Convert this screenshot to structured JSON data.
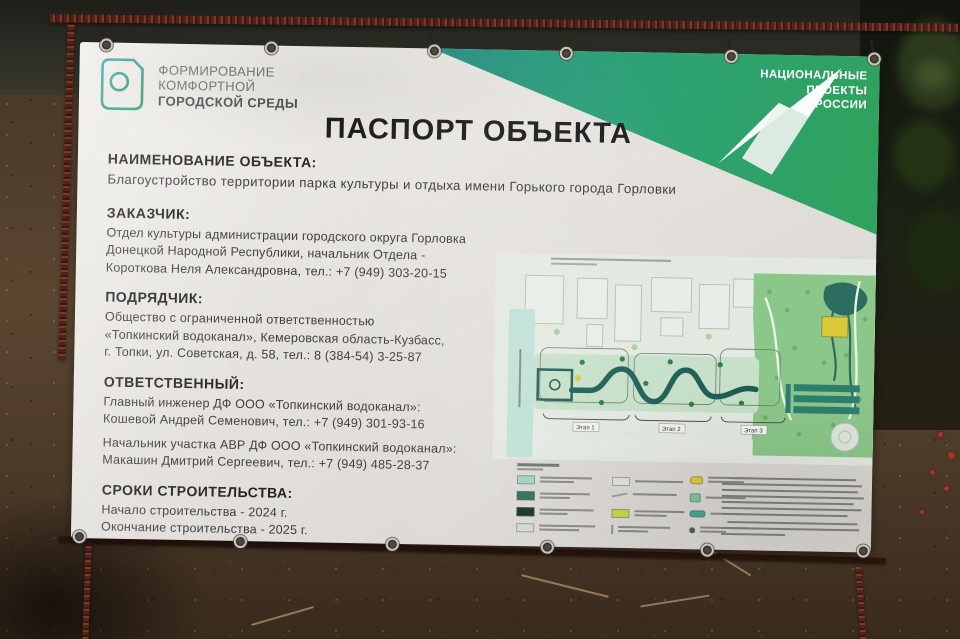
{
  "banner": {
    "program_logo": {
      "icon": "fkgs-window-f-icon",
      "line1": "ФОРМИРОВАНИЕ",
      "line2": "КОМФОРТНОЙ",
      "line3": "ГОРОДСКОЙ СРЕДЫ",
      "color": "#2c9c8c"
    },
    "national_projects": {
      "line1": "НАЦИОНАЛЬНЫЕ",
      "line2": "ПРОЕКТЫ",
      "line3": "РОССИИ",
      "band_teal": "#2a9387",
      "band_green": "#2fa25d"
    },
    "title": "ПАСПОРТ ОБЪЕКТА",
    "sections": [
      {
        "heading": "НАИМЕНОВАНИЕ ОБЪЕКТА:",
        "lines": [
          "Благоустройство территории парка культуры и отдыха имени Горького города Горловки"
        ]
      },
      {
        "heading": "ЗАКАЗЧИК:",
        "lines": [
          "Отдел культуры администрации городского округа Горловка",
          "Донецкой Народной Республики, начальник Отдела -",
          "Короткова Неля Александровна, тел.: +7 (949) 303-20-15"
        ]
      },
      {
        "heading": "ПОДРЯДЧИК:",
        "lines": [
          "Общество с ограниченной ответственностью",
          "«Топкинский водоканал», Кемеровская область-Кузбасс,",
          "г. Топки, ул. Советская, д. 58, тел.: 8 (384-54) 3-25-87"
        ]
      },
      {
        "heading": "ОТВЕТСТВЕННЫЙ:",
        "lines": [
          "Главный инженер ДФ ООО «Топкинский водоканал»:",
          "Кошевой Андрей Семенович, тел.: +7 (949) 301-93-16",
          "Начальник участка АВР ДФ ООО «Топкинский водоканал»:",
          "Макашин Дмитрий Сергеевич, тел.: +7 (949) 485-28-37"
        ]
      },
      {
        "heading": "СРОКИ СТРОИТЕЛЬСТВА:",
        "lines": [
          "Начало строительства - 2024 г.",
          "Окончание строительства - 2025 г."
        ]
      }
    ],
    "map": {
      "stage_labels": [
        "Этап 1",
        "Этап 2",
        "Этап 3"
      ],
      "colors": {
        "plan_background": "#e3e9e1",
        "park_green": "#8cc78a",
        "path_teal": "#1f5e55",
        "water_teal": "#2d6d60",
        "highlight_yellow": "#d9c838",
        "street_teal": "#bfe0d6"
      },
      "legend_swatches": [
        "#a6d2c6",
        "#2e6f5f",
        "#152f27",
        "#d6dad5",
        "#dfe3de",
        "#c4d64b",
        "#dfc93c",
        "#4aa595"
      ]
    }
  }
}
